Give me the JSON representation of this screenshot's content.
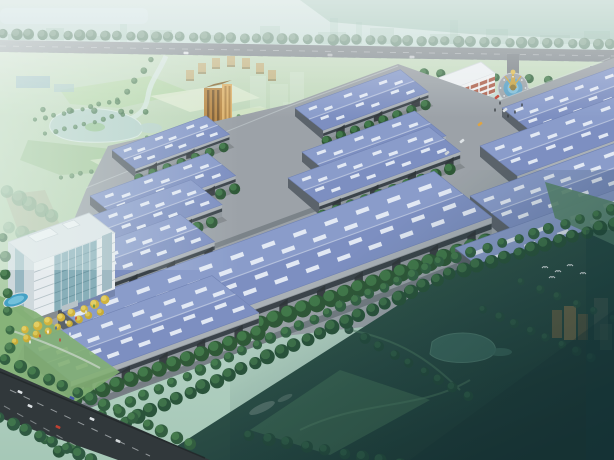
{
  "scene": {
    "title": "aerial-rendering-industrial-park",
    "width": 614,
    "height": 460,
    "description": "Bird's-eye architectural rendering of an industrial logistics park with blue-roofed warehouses, office building, entrance roundabout with fountain, surrounded by hazy parkland and dark green fields"
  },
  "colors": {
    "sky": "#c6ded8",
    "skyDeep": "#a9ccbe",
    "skylineBlock": "#8fb8a6",
    "waterBand": "#d4e6ea",
    "roadTop": "#848b90",
    "roadDark": "#2a3033",
    "roadPark": "#7a8186",
    "parkLight": "#c8ddc2",
    "parkDeep": "#a9cba2",
    "pond": "#b9d4cc",
    "stream": "#d7e8e0",
    "hullConcrete": "#9aa0a6",
    "roofBack": "#8799ca",
    "roofFront": "#7a8cc0",
    "ridge": "#bcc7e2",
    "eave": "#6d7fb2",
    "skylight": "#e9eef8",
    "wall": "#8d9399",
    "wallTop": "#a9afb5",
    "wallBand": "#343c43",
    "door": "#282d32",
    "endWall": "#565d66",
    "treeDark": "#27522f",
    "treeLight": "#3f7a46",
    "fieldA": "#35604d",
    "fieldB": "#23473f",
    "fieldC": "#132f2d",
    "fieldPond": "#39685c",
    "officeWhite": "#e9eef1",
    "officeEnd": "#cfd8dd",
    "officeGlass": "#7fa9b4",
    "officeRoof": "#dde4e8",
    "adminWhite": "#f0f1f2",
    "adminBand": "#a8503a",
    "grayFace": "#8d98a0",
    "grayBandDark": "#5c666e",
    "grayEnd": "#6b757d",
    "grayRoof": "#aeb7bd",
    "towerOrange": "#b9853f",
    "towerOrangeLight": "#dfb269",
    "fountainPlaza": "#9aa1a7",
    "fountainWater": "#57a0c6",
    "sculptureGold": "#c9a23c",
    "poolBlue": "#3f9fc4",
    "poolInner": "#6fc0dc",
    "goldTree": "#d2b136",
    "goldTreeHl": "#e9d465"
  },
  "geometry": {
    "u": [
      0.94,
      -0.342
    ],
    "v": [
      0.78,
      0.62
    ]
  },
  "warehouses": [
    {
      "x": 112,
      "y": 150,
      "len": 100,
      "wid": 30,
      "wall": 9
    },
    {
      "x": 295,
      "y": 108,
      "len": 112,
      "wid": 36,
      "wall": 10
    },
    {
      "x": 502,
      "y": 108,
      "len": 128,
      "wid": 42,
      "wall": 11
    },
    {
      "x": 90,
      "y": 196,
      "len": 125,
      "wid": 36,
      "wall": 11
    },
    {
      "x": 302,
      "y": 152,
      "len": 120,
      "wid": 40,
      "wall": 12
    },
    {
      "x": 480,
      "y": 146,
      "len": 150,
      "wid": 48,
      "wall": 13
    },
    {
      "x": 64,
      "y": 226,
      "len": 135,
      "wid": 40,
      "wall": 12
    },
    {
      "x": 288,
      "y": 178,
      "len": 150,
      "wid": 40,
      "wall": 12
    },
    {
      "x": 470,
      "y": 196,
      "len": 160,
      "wid": 54,
      "wall": 15
    },
    {
      "x": 44,
      "y": 264,
      "len": 145,
      "wid": 44,
      "wall": 14
    },
    {
      "x": 58,
      "y": 308,
      "len": 400,
      "wid": 74,
      "wall": 21
    },
    {
      "x": 455,
      "y": 248,
      "len": 175,
      "wid": 70,
      "wall": 17
    },
    {
      "x": 24,
      "y": 344,
      "len": 200,
      "wid": 60,
      "wall": 18
    }
  ],
  "skyline_blocks": [
    {
      "x": 8,
      "w": 26,
      "h": 10
    },
    {
      "x": 46,
      "w": 18,
      "h": 16
    },
    {
      "x": 80,
      "w": 30,
      "h": 8
    },
    {
      "x": 120,
      "w": 7,
      "h": 20
    },
    {
      "x": 150,
      "w": 22,
      "h": 14
    },
    {
      "x": 200,
      "w": 34,
      "h": 9
    },
    {
      "x": 260,
      "w": 20,
      "h": 18
    },
    {
      "x": 318,
      "w": 28,
      "h": 12
    },
    {
      "x": 330,
      "w": 8,
      "h": 26
    },
    {
      "x": 356,
      "w": 6,
      "h": 22
    },
    {
      "x": 370,
      "w": 24,
      "h": 16
    },
    {
      "x": 430,
      "w": 30,
      "h": 10
    },
    {
      "x": 450,
      "w": 8,
      "h": 24
    },
    {
      "x": 486,
      "w": 22,
      "h": 15
    },
    {
      "x": 540,
      "w": 30,
      "h": 9
    },
    {
      "x": 584,
      "w": 26,
      "h": 13
    }
  ],
  "tree_rows": [
    {
      "layer": "top",
      "pts": [
        [
          4,
          34
        ],
        [
          610,
          44
        ]
      ],
      "step": 12.5,
      "r": 5.2,
      "c": "#6f927e",
      "hl": "#8aa893",
      "o": 0.9
    },
    {
      "layer": "top",
      "pts": [
        [
          0,
          56
        ],
        [
          612,
          66
        ]
      ],
      "step": 13,
      "r": 5.4,
      "c": "#55795f",
      "hl": "#6f9478",
      "o": 0.95
    },
    {
      "layer": "admin",
      "pts": [
        [
          406,
          72
        ],
        [
          548,
          80
        ]
      ],
      "step": 16,
      "r": 4.4,
      "c": "#35663f",
      "hl": "#4d8453"
    },
    {
      "layer": "admin",
      "pts": [
        [
          544,
          138
        ],
        [
          606,
          150
        ]
      ],
      "step": 15,
      "r": 4.5,
      "c": "#2e5c3a",
      "hl": "#447a4c"
    },
    {
      "layer": "park",
      "pts": [
        [
          36,
          120
        ],
        [
          118,
          100
        ]
      ],
      "step": 9,
      "r": 2.3,
      "c": "#4a7a52",
      "hl": "#5f9162",
      "o": 0.85
    },
    {
      "layer": "park",
      "pts": [
        [
          46,
          134
        ],
        [
          132,
          112
        ]
      ],
      "step": 9,
      "r": 2.3,
      "c": "#4a7a52",
      "hl": "#5f9162",
      "o": 0.85
    },
    {
      "layer": "park",
      "pts": [
        [
          148,
          138
        ],
        [
          238,
          116
        ]
      ],
      "step": 9,
      "r": 2.3,
      "c": "#4a7a52",
      "hl": "#5f9162",
      "o": 0.8
    },
    {
      "layer": "park",
      "pts": [
        [
          160,
          152
        ],
        [
          250,
          130
        ]
      ],
      "step": 9,
      "r": 2.3,
      "c": "#4a7a52",
      "hl": "#5f9162",
      "o": 0.8
    },
    {
      "layer": "park",
      "pts": [
        [
          62,
          178
        ],
        [
          148,
          158
        ]
      ],
      "step": 9,
      "r": 2.3,
      "c": "#4a7a52",
      "hl": "#5f9162",
      "o": 0.75
    },
    {
      "layer": "park",
      "pts": [
        [
          188,
          168
        ],
        [
          276,
          146
        ]
      ],
      "step": 9,
      "r": 2.3,
      "c": "#4a7a52",
      "hl": "#5f9162",
      "o": 0.75
    },
    {
      "layer": "park",
      "pts": [
        [
          152,
          60
        ],
        [
          118,
          102
        ]
      ],
      "step": 11,
      "r": 3,
      "c": "#3e6f48",
      "hl": "#578a5c",
      "o": 0.8
    },
    {
      "layer": "park",
      "pts": [
        [
          44,
          110
        ],
        [
          146,
          112
        ]
      ],
      "step": 24,
      "r": 3,
      "c": "#3e6f48",
      "hl": "#578a5c",
      "o": 0.8
    },
    {
      "layer": "park",
      "pts": [
        [
          8,
          192
        ],
        [
          52,
          216
        ]
      ],
      "step": 11,
      "r": 7,
      "c": "#6f9d7c",
      "hl": "#87b28f",
      "o": 0.6
    },
    {
      "layer": "park",
      "pts": [
        [
          10,
          228
        ],
        [
          46,
          242
        ]
      ],
      "step": 12,
      "r": 6.5,
      "c": "#6f9d7c",
      "hl": "#87b28f",
      "o": 0.55
    },
    {
      "layer": "plaza",
      "pts": [
        [
          26,
          330
        ],
        [
          106,
          300
        ]
      ],
      "step": 11,
      "r": 4.2,
      "c": "#d2b136",
      "hl": "#e9d465"
    },
    {
      "layer": "plaza",
      "pts": [
        [
          16,
          342
        ],
        [
          100,
          312
        ]
      ],
      "step": 11,
      "r": 3.6,
      "c": "#c8a930",
      "hl": "#e0cb58"
    },
    {
      "layer": "plaza",
      "pts": [
        [
          4,
          238
        ],
        [
          10,
          348
        ]
      ],
      "step": 18,
      "r": 5,
      "c": "#35663f",
      "hl": "#4d8453"
    },
    {
      "layer": "field",
      "pts": [
        [
          350,
          330
        ],
        [
          468,
          396
        ]
      ],
      "step": 16,
      "r": 5,
      "c": "#1d4434",
      "hl": "#2a5a42",
      "o": 0.9
    },
    {
      "layer": "field",
      "pts": [
        [
          250,
          436
        ],
        [
          400,
          464
        ]
      ],
      "step": 17,
      "r": 6,
      "c": "#1d4434",
      "hl": "#2a5a42",
      "o": 0.9
    },
    {
      "layer": "field",
      "pts": [
        [
          484,
          310
        ],
        [
          592,
          358
        ]
      ],
      "step": 15,
      "r": 4.5,
      "c": "#1f4838",
      "hl": "#2d5c44",
      "o": 0.85
    },
    {
      "layer": "field",
      "pts": [
        [
          522,
          282
        ],
        [
          612,
          318
        ]
      ],
      "step": 18,
      "r": 4,
      "c": "#234d3b",
      "hl": "#306046",
      "o": 0.8
    },
    {
      "layer": "boundary",
      "pts": [
        [
          46,
          440
        ],
        [
          440,
          262
        ],
        [
          612,
          210
        ]
      ],
      "step": 15,
      "r": 5.2,
      "c": "#2d5c3c",
      "hl": "#427a49"
    },
    {
      "layer": "boundary",
      "pts": [
        [
          60,
          452
        ],
        [
          450,
          274
        ],
        [
          614,
          224
        ]
      ],
      "step": 14,
      "r": 6.8,
      "c": "#224d33",
      "hl": "#3c7347"
    },
    {
      "layer": "road",
      "pts": [
        [
          6,
          360
        ],
        [
          190,
          444
        ]
      ],
      "step": 15,
      "r": 6,
      "c": "#2b5838",
      "hl": "#437c49"
    },
    {
      "layer": "road",
      "pts": [
        [
          0,
          418
        ],
        [
          92,
          460
        ]
      ],
      "step": 14,
      "r": 6,
      "c": "#27533a",
      "hl": "#3d7548"
    }
  ],
  "arc_buildings": [
    {
      "x": 186,
      "y": 70
    },
    {
      "x": 198,
      "y": 63
    },
    {
      "x": 212,
      "y": 58
    },
    {
      "x": 227,
      "y": 56
    },
    {
      "x": 242,
      "y": 58
    },
    {
      "x": 256,
      "y": 63
    },
    {
      "x": 268,
      "y": 70
    }
  ],
  "ghost_park": [
    {
      "x": 250,
      "y": 76,
      "w": 16,
      "h": 32,
      "o": 0.32
    },
    {
      "x": 270,
      "y": 84,
      "w": 18,
      "h": 26,
      "o": 0.3
    },
    {
      "x": 290,
      "y": 72,
      "w": 14,
      "h": 36,
      "o": 0.34
    },
    {
      "x": 283,
      "y": 102,
      "w": 20,
      "h": 16,
      "o": 0.25
    }
  ],
  "ghost_field": [
    {
      "x": 552,
      "y": 310,
      "w": 10,
      "h": 28,
      "c": "#8a6b42",
      "o": 0.55
    },
    {
      "x": 564,
      "y": 306,
      "w": 12,
      "h": 34,
      "c": "#9a7848",
      "o": 0.6
    },
    {
      "x": 578,
      "y": 314,
      "w": 10,
      "h": 26,
      "c": "#7a5f3c",
      "o": 0.5
    },
    {
      "x": 594,
      "y": 298,
      "w": 14,
      "h": 42,
      "c": "#6f7866",
      "o": 0.35
    },
    {
      "x": 600,
      "y": 324,
      "w": 12,
      "h": 26,
      "c": "#5d7060",
      "o": 0.4
    }
  ],
  "cars": [
    {
      "x": 30,
      "y": 406,
      "rot": 24,
      "c": "#dfe3e6"
    },
    {
      "x": 58,
      "y": 427,
      "rot": 24,
      "c": "#c0392b"
    },
    {
      "x": 92,
      "y": 419,
      "rot": 24,
      "c": "#dfe3e6"
    },
    {
      "x": 72,
      "y": 398,
      "rot": 24,
      "c": "#3f51a5"
    },
    {
      "x": 118,
      "y": 441,
      "rot": 24,
      "c": "#d4d8db"
    },
    {
      "x": 20,
      "y": 392,
      "rot": 24,
      "c": "#dfe3e6"
    },
    {
      "x": 497,
      "y": 97,
      "rot": -38,
      "c": "#c0392b"
    },
    {
      "x": 505,
      "y": 110,
      "rot": -38,
      "c": "#dfe3e6"
    },
    {
      "x": 480,
      "y": 124,
      "rot": -38,
      "c": "#e0a23a"
    },
    {
      "x": 462,
      "y": 141,
      "rot": -38,
      "c": "#dfe3e6"
    },
    {
      "x": 447,
      "y": 153,
      "rot": -38,
      "c": "#cfd3d6"
    },
    {
      "x": 186,
      "y": 53,
      "rot": 2,
      "c": "#dfe3e6"
    },
    {
      "x": 412,
      "y": 57,
      "rot": 2,
      "c": "#c8ccd0"
    },
    {
      "x": 330,
      "y": 55,
      "rot": 2,
      "c": "#b8bcbf"
    }
  ],
  "people": [
    {
      "x": 40,
      "y": 336,
      "c": "#c0392b"
    },
    {
      "x": 48,
      "y": 332,
      "c": "#ffffff"
    },
    {
      "x": 56,
      "y": 328,
      "c": "#2e5aa8"
    },
    {
      "x": 66,
      "y": 322,
      "c": "#ffffff"
    },
    {
      "x": 76,
      "y": 318,
      "c": "#c0392b"
    },
    {
      "x": 86,
      "y": 312,
      "c": "#e0e4e8"
    },
    {
      "x": 30,
      "y": 342,
      "c": "#ffffff"
    },
    {
      "x": 94,
      "y": 306,
      "c": "#3a8a4a"
    },
    {
      "x": 60,
      "y": 340,
      "c": "#c0392b"
    },
    {
      "x": 70,
      "y": 334,
      "c": "#ffffff"
    },
    {
      "x": 500,
      "y": 103,
      "c": "#2e3338"
    },
    {
      "x": 495,
      "y": 110,
      "c": "#2e3338"
    },
    {
      "x": 508,
      "y": 116,
      "c": "#2e3338"
    },
    {
      "x": 515,
      "y": 112,
      "c": "#2e3338"
    },
    {
      "x": 522,
      "y": 105,
      "c": "#2e3338"
    }
  ],
  "birds": [
    [
      545,
      268
    ],
    [
      558,
      272
    ],
    [
      570,
      266
    ],
    [
      583,
      274
    ],
    [
      552,
      278
    ]
  ]
}
